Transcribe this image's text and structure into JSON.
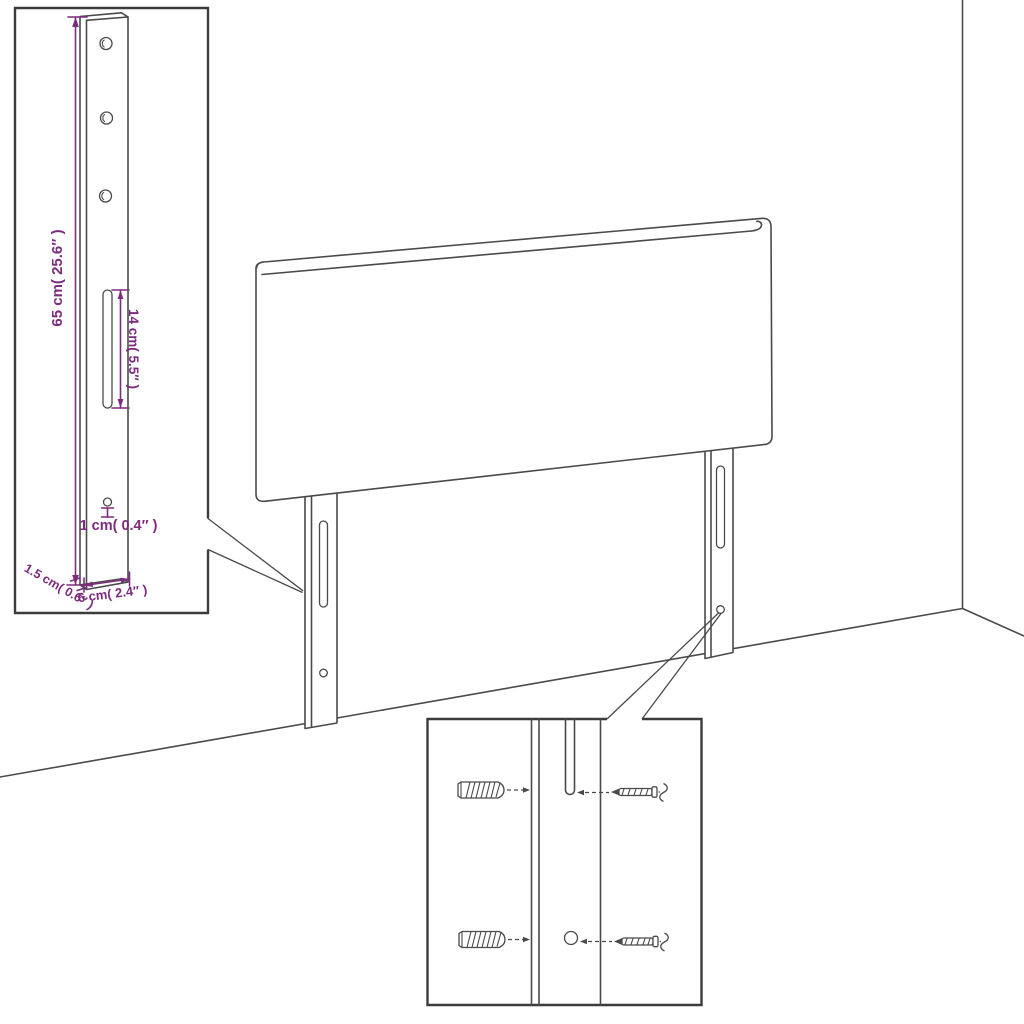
{
  "labels": {
    "total_height": "65 cm( 25.6″ )",
    "slot_length": "14 cm( 5.5″ )",
    "hole_size": "1 cm( 0.4″ )",
    "thickness": "1.5 cm( 0.6″ )",
    "leg_width": "6 cm( 2.4″ )"
  },
  "colors": {
    "dimension_text": "#7D2B7D",
    "drawing_line": "#4A4A4A",
    "detail_box_border": "#3C3C3C",
    "background": "#FFFFFF"
  },
  "icons": {
    "wall_plug": "wall-plug-icon",
    "screw": "screw-icon",
    "mounting_slot": "slot-shape",
    "screw_hole": "hole-circle"
  }
}
